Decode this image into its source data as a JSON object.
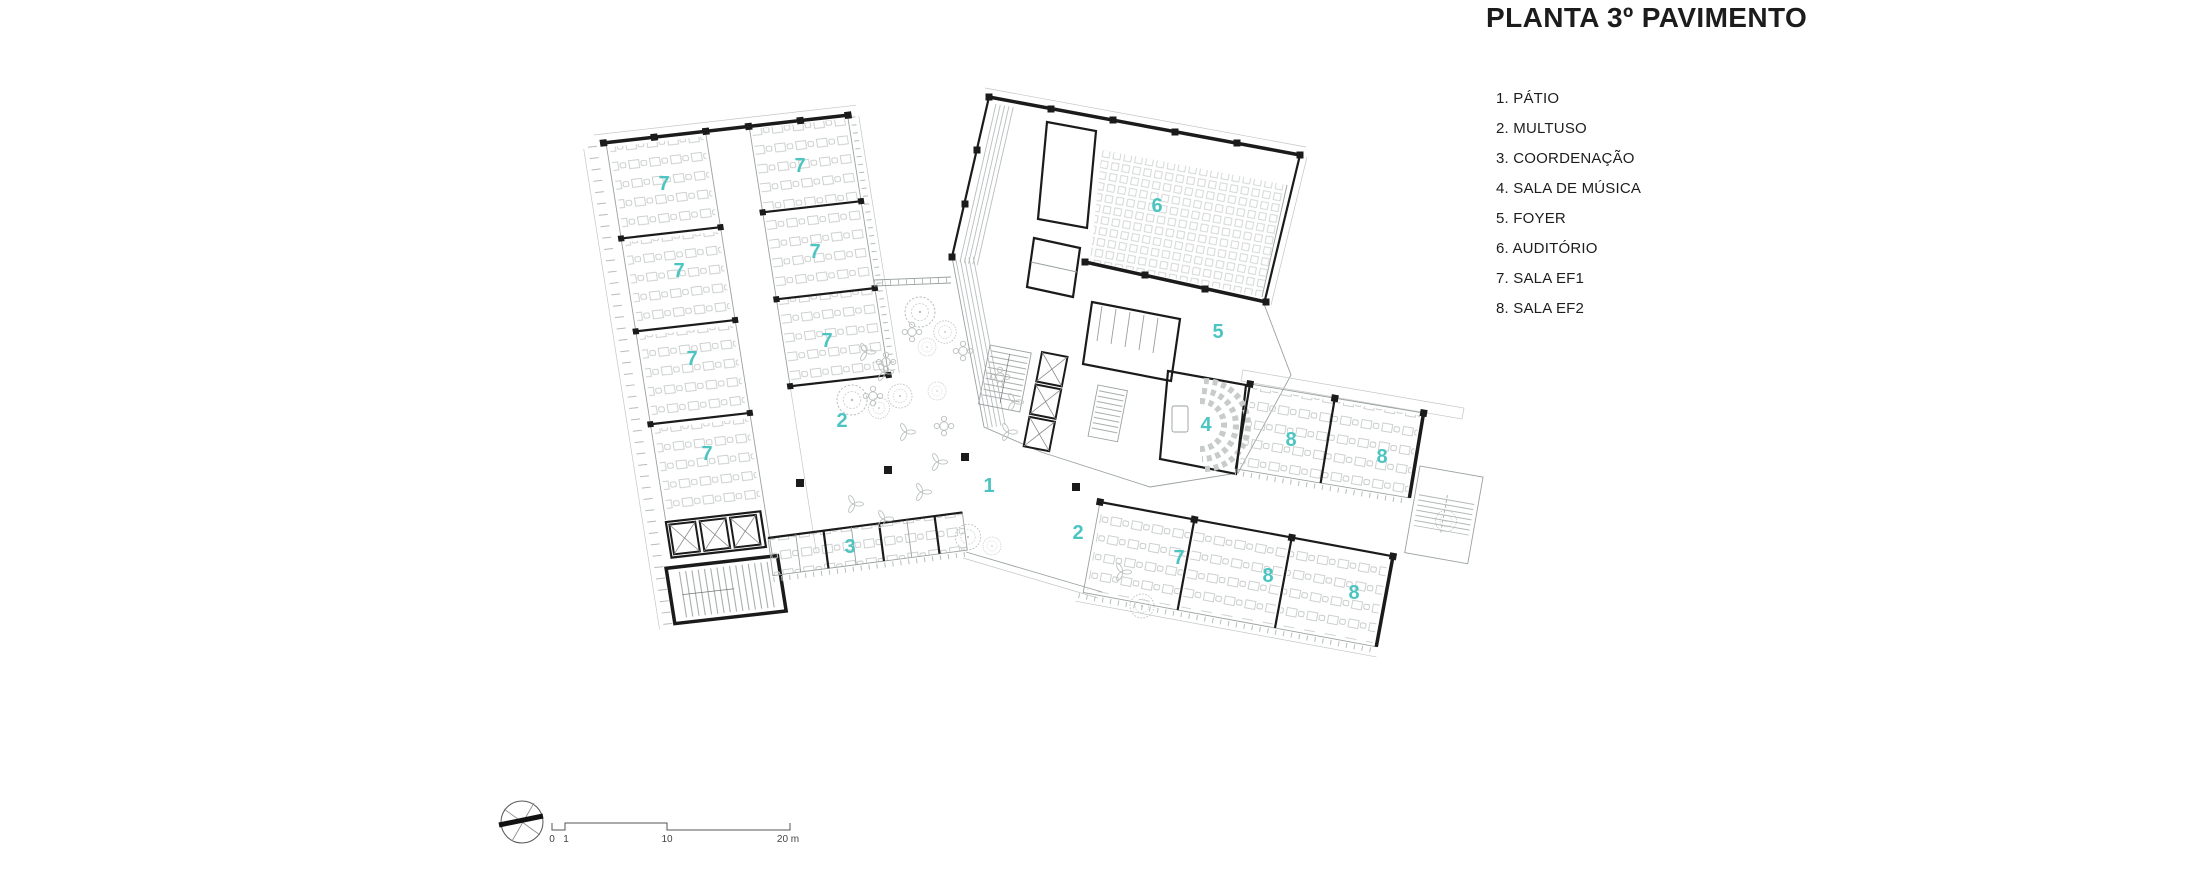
{
  "title": "PLANTA 3º PAVIMENTO",
  "legend": {
    "items": [
      "1. PÁTIO",
      "2. MULTUSO",
      "3. COORDENAÇÃO",
      "4. SALA DE MÚSICA",
      "5. FOYER",
      "6. AUDITÓRIO",
      "7. SALA EF1",
      "8. SALA EF2"
    ]
  },
  "plan": {
    "room_labels": [
      {
        "number": "7",
        "x": 664,
        "y": 183
      },
      {
        "number": "7",
        "x": 800,
        "y": 165
      },
      {
        "number": "7",
        "x": 679,
        "y": 270
      },
      {
        "number": "7",
        "x": 815,
        "y": 251
      },
      {
        "number": "7",
        "x": 692,
        "y": 358
      },
      {
        "number": "7",
        "x": 827,
        "y": 340
      },
      {
        "number": "7",
        "x": 707,
        "y": 453
      },
      {
        "number": "6",
        "x": 1157,
        "y": 205
      },
      {
        "number": "5",
        "x": 1218,
        "y": 331
      },
      {
        "number": "4",
        "x": 1206,
        "y": 424
      },
      {
        "number": "8",
        "x": 1291,
        "y": 439
      },
      {
        "number": "8",
        "x": 1382,
        "y": 456
      },
      {
        "number": "7",
        "x": 1179,
        "y": 557
      },
      {
        "number": "8",
        "x": 1268,
        "y": 575
      },
      {
        "number": "8",
        "x": 1354,
        "y": 592
      },
      {
        "number": "1",
        "x": 989,
        "y": 485
      },
      {
        "number": "2",
        "x": 842,
        "y": 420
      },
      {
        "number": "2",
        "x": 1078,
        "y": 532
      },
      {
        "number": "3",
        "x": 850,
        "y": 546
      }
    ]
  },
  "scale_bar": {
    "labels": [
      "0",
      "1",
      "10",
      "20 m"
    ]
  },
  "north_arrow": {
    "icon": "north-arrow"
  },
  "colors": {
    "accent": "#4CC5C2",
    "wall": "#1b1b1b",
    "thin_line": "#9aa0a0",
    "furniture": "#c7cbca",
    "tree": "#b8beb8"
  }
}
